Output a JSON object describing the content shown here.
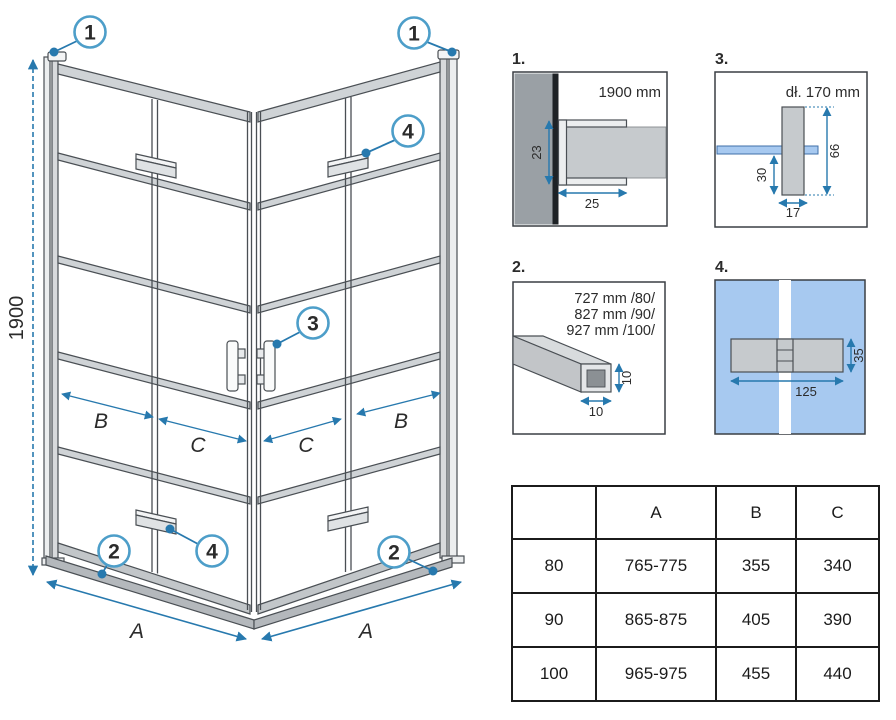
{
  "colors": {
    "dimension_blue": "#2779ae",
    "callout_circle_blue": "#4d9ec9",
    "glass_light_blue": "#a7c9f0",
    "profile_gray": "#c6cacd",
    "wall_gray": "#9aa0a5",
    "line_dark": "#4a4f54",
    "table_border": "#1b1b1b"
  },
  "main": {
    "height_dim": "1900",
    "width_dim": "A",
    "dim_b": "B",
    "dim_c": "C",
    "callout_1": "1",
    "callout_2": "2",
    "callout_3": "3",
    "callout_4": "4"
  },
  "details": {
    "d1": {
      "num": "1.",
      "title": "1900 mm",
      "dim_depth": "23",
      "dim_width": "25"
    },
    "d2": {
      "num": "2.",
      "size_80": "727 mm /80/",
      "size_90": "827 mm /90/",
      "size_100": "927 mm /100/",
      "dim_height": "10",
      "dim_width": "10"
    },
    "d3": {
      "num": "3.",
      "title": "dł. 170 mm",
      "dim_total": "66",
      "dim_lower": "30",
      "dim_width": "17"
    },
    "d4": {
      "num": "4.",
      "dim_width": "125",
      "dim_height": "35"
    }
  },
  "table": {
    "headers": [
      "",
      "A",
      "B",
      "C"
    ],
    "rows": [
      [
        "80",
        "765-775",
        "355",
        "340"
      ],
      [
        "90",
        "865-875",
        "405",
        "390"
      ],
      [
        "100",
        "965-975",
        "455",
        "440"
      ]
    ]
  }
}
